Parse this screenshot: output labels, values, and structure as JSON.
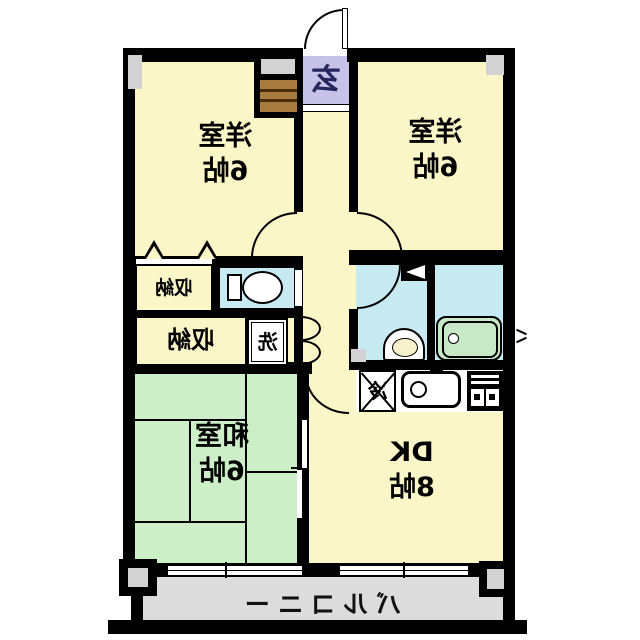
{
  "rooms": {
    "west_bedroom": {
      "label": "洋室",
      "size": "6帖"
    },
    "east_bedroom": {
      "label": "洋室",
      "size": "6帖"
    },
    "tatami_room": {
      "label": "和室",
      "size": "6帖"
    },
    "dining_kitchen": {
      "label": "DK",
      "size": "8帖"
    }
  },
  "storage": {
    "closet1": {
      "label": "収納"
    },
    "closet2": {
      "label": "収納"
    }
  },
  "entrance": {
    "label": "玄"
  },
  "laundry": {
    "label": "洗"
  },
  "refrigerator": {
    "label": "冷"
  },
  "balcony": {
    "label": "バルコニー"
  },
  "colors": {
    "wall": "#000000",
    "room_yellow": "#FAF6C8",
    "tatami_green": "#CDEFC8",
    "water_blue": "#C7EAF2",
    "entrance_lavender": "#C7C3E8",
    "balcony_gray": "#DCDCDC",
    "pillar_gray": "#D2D2D2",
    "cabinet_brown": "#A87C3E",
    "tub_green": "#C8E9C6",
    "entrance_glyph_navy": "#26265E"
  },
  "icons": [
    "toilet-icon",
    "washbasin-icon",
    "bathtub-icon",
    "kitchen-sink-icon",
    "stove-icon",
    "refrigerator-icon",
    "shoe-cabinet-icon",
    "door-arc-icon",
    "folding-door-icon",
    "sliding-window-icon",
    "closet-triangle-icon",
    "pillar-icon"
  ],
  "note_mirrored": true
}
